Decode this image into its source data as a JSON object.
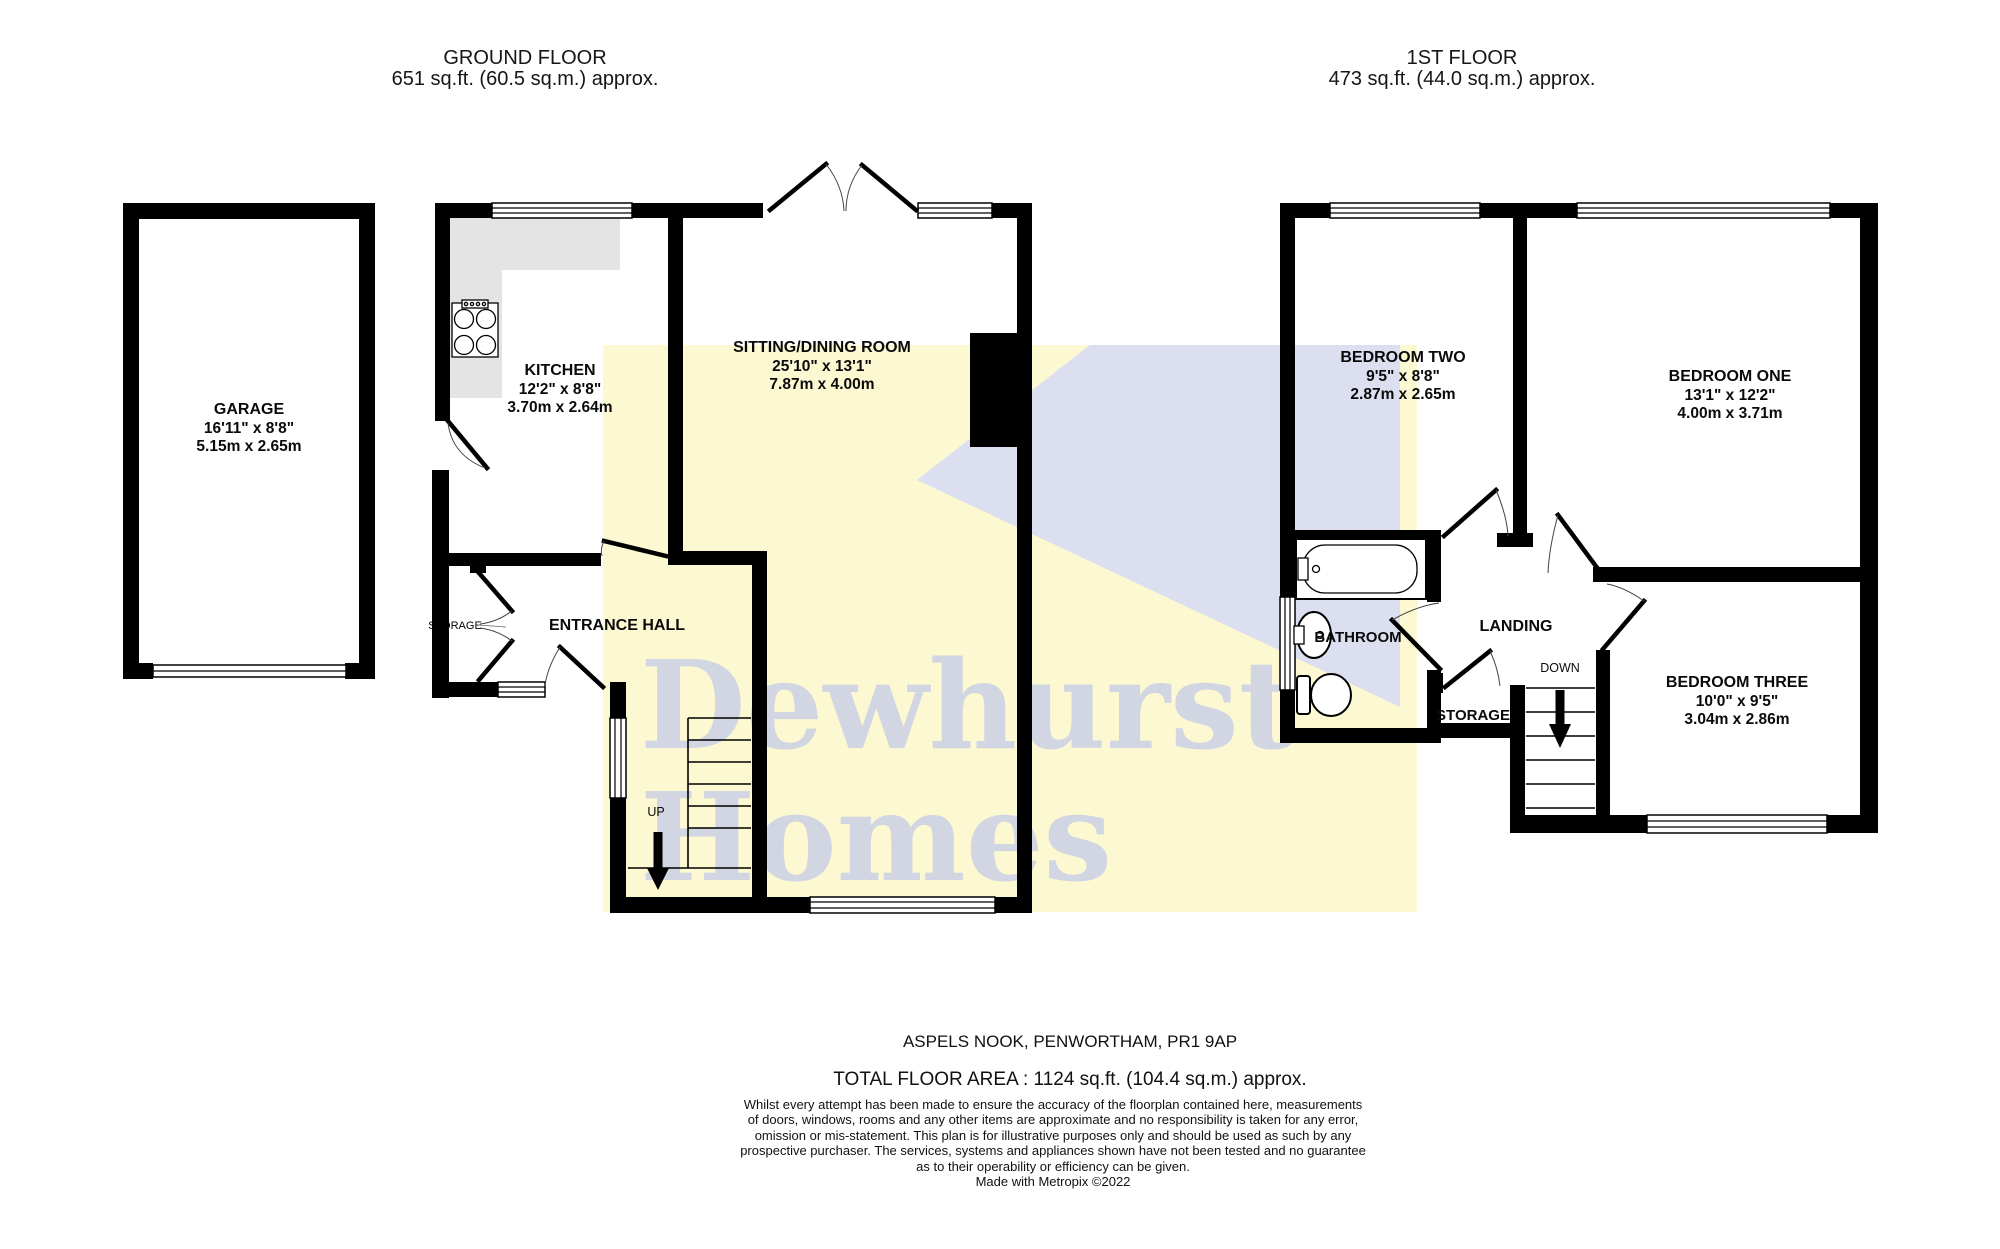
{
  "floors": {
    "ground": {
      "title": "GROUND FLOOR",
      "area": "651 sq.ft. (60.5 sq.m.) approx."
    },
    "first": {
      "title": "1ST FLOOR",
      "area": "473 sq.ft. (44.0 sq.m.) approx."
    }
  },
  "rooms": {
    "garage": {
      "name": "GARAGE",
      "imperial": "16'11\"  x 8'8\"",
      "metric": "5.15m  x 2.65m"
    },
    "kitchen": {
      "name": "KITCHEN",
      "imperial": "12'2\"  x 8'8\"",
      "metric": "3.70m  x 2.64m"
    },
    "sitting_dining": {
      "name": "SITTING/DINING ROOM",
      "imperial": "25'10\"  x 13'1\"",
      "metric": "7.87m  x 4.00m"
    },
    "entrance_hall": {
      "name": "ENTRANCE HALL"
    },
    "hall_storage": {
      "name": "STORAGE"
    },
    "bedroom_two": {
      "name": "BEDROOM TWO",
      "imperial": "9'5\"  x 8'8\"",
      "metric": "2.87m  x 2.65m"
    },
    "bedroom_one": {
      "name": "BEDROOM ONE",
      "imperial": "13'1\"  x 12'2\"",
      "metric": "4.00m  x 3.71m"
    },
    "bedroom_three": {
      "name": "BEDROOM THREE",
      "imperial": "10'0\"  x 9'5\"",
      "metric": "3.04m  x 2.86m"
    },
    "bathroom": {
      "name": "BATHROOM"
    },
    "landing": {
      "name": "LANDING"
    },
    "storage": {
      "name": "STORAGE"
    }
  },
  "stairs": {
    "up": "UP",
    "down": "DOWN"
  },
  "watermark": {
    "line1": "Dewhurst",
    "line2": "Homes"
  },
  "footer": {
    "address": "ASPELS NOOK, PENWORTHAM, PR1 9AP",
    "total_area": "TOTAL FLOOR AREA : 1124 sq.ft. (104.4 sq.m.) approx.",
    "disclaimer": [
      "Whilst every attempt has been made to ensure the accuracy of the floorplan contained here, measurements",
      "of doors, windows, rooms and any other items are approximate and no responsibility is taken for any error,",
      "omission or mis-statement. This plan is for illustrative purposes only and should be used as such by any",
      "prospective purchaser. The services, systems and appliances shown have not been tested and no guarantee",
      "as to their operability or efficiency can be given.",
      "Made with Metropix ©2022"
    ]
  },
  "colors": {
    "yellow": "#fbf8d2",
    "lavender": "#dbdfef",
    "watermark_text": "#c8cde6",
    "counter_gray": "#e4e4e4"
  }
}
